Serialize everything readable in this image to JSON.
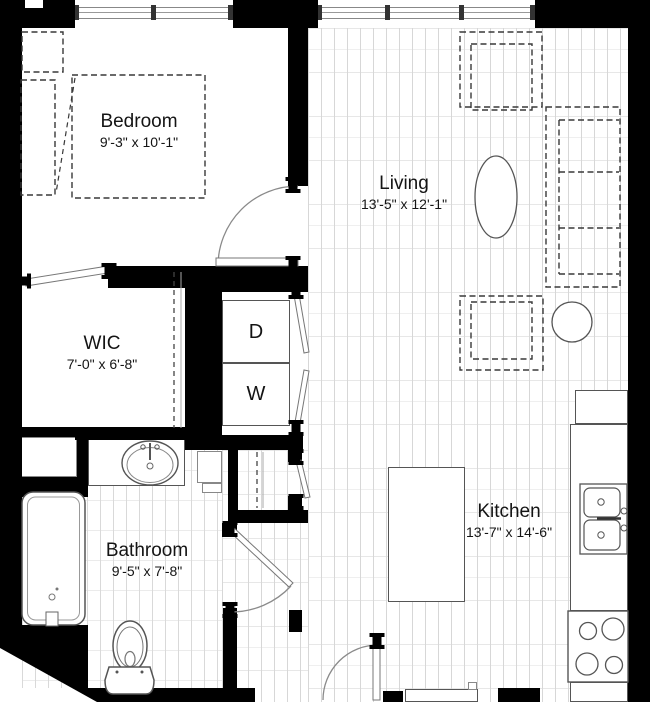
{
  "floorplan": {
    "title": "Apartment floor plan",
    "rooms": [
      {
        "id": "bedroom",
        "name": "Bedroom",
        "dimensions": "9'-3\" x 10'-1\""
      },
      {
        "id": "living",
        "name": "Living",
        "dimensions": "13'-5\" x 12'-1\""
      },
      {
        "id": "wic",
        "name": "WIC",
        "dimensions": "7'-0\" x 6'-8\""
      },
      {
        "id": "bathroom",
        "name": "Bathroom",
        "dimensions": "9'-5\" x 7'-8\""
      },
      {
        "id": "kitchen",
        "name": "Kitchen",
        "dimensions": "13'-7\" x 14'-6\""
      }
    ],
    "appliances": {
      "dryer": "D",
      "washer": "W"
    },
    "colors": {
      "wall": "#000000",
      "floor_line": "#d7d7d7",
      "fixture_line": "#555555",
      "dashed_furniture": "#383838",
      "text": "#141414",
      "background": "#ffffff"
    }
  }
}
